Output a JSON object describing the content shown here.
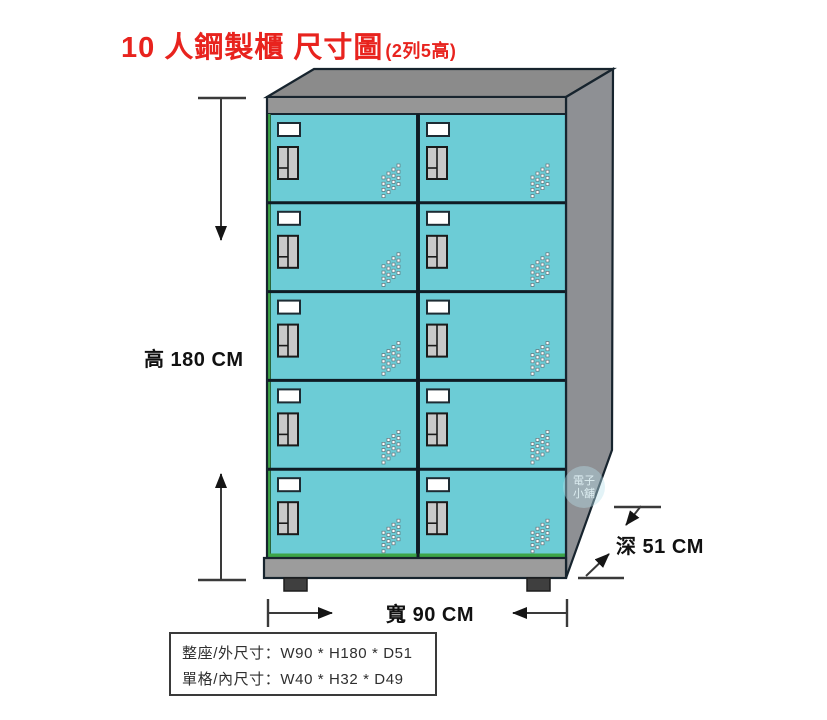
{
  "title": {
    "text": "10 人鋼製櫃 尺寸圖",
    "suffix": "(2列5高)"
  },
  "diagram": {
    "height_label": "高 180 CM",
    "width_label": "寬 90 CM",
    "depth_label": "深 51 CM"
  },
  "locker": {
    "columns": 2,
    "rows": 5,
    "door_count": 10,
    "door_color": "#6CCCD6",
    "top_color": "#8B8B8B",
    "band_color": "#969696",
    "side_color": "#8E9094",
    "base_color": "#9C9C9C",
    "foot_color": "#3F3F3F",
    "accent_green": "#3DA548",
    "outline_color": "#17242E",
    "title_red": "#E8231E"
  },
  "spec_box": {
    "line1": "整座/外尺寸：W90 * H180 * D51",
    "line2": "單格/內尺寸：W40 * H32 * D49"
  },
  "watermark": {
    "line1": "電子",
    "line2": "小舖"
  }
}
